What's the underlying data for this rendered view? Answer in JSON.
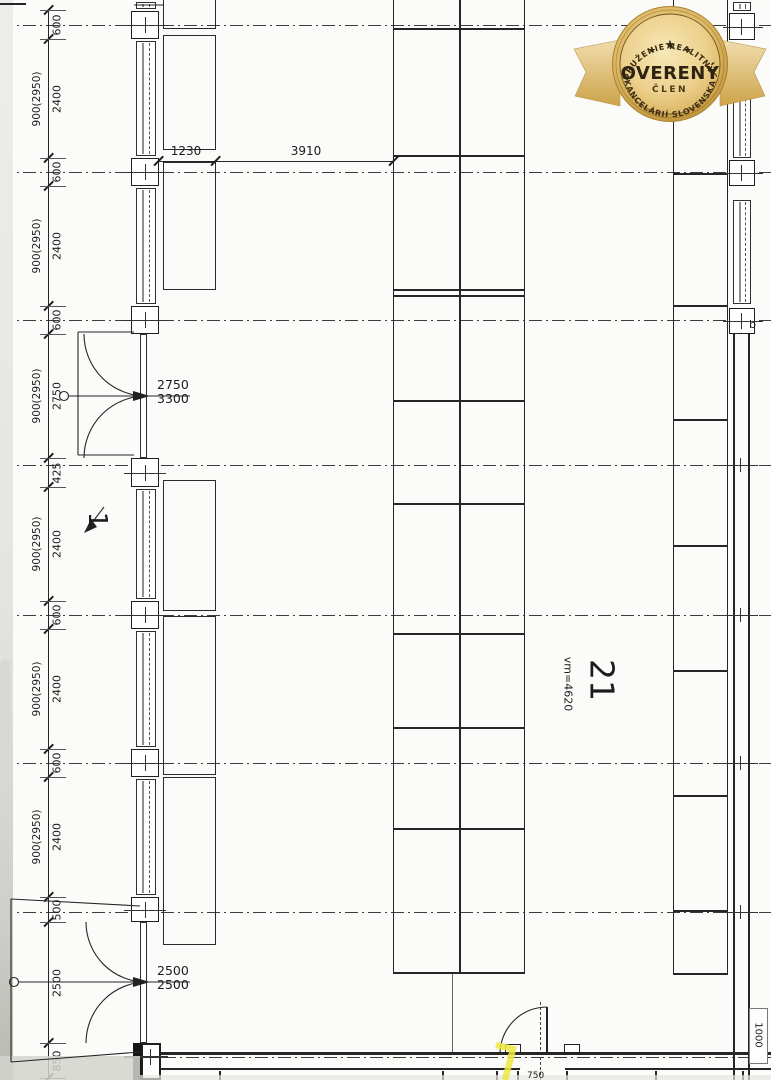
{
  "badge": {
    "arc_top": "ZDRUŽENIE REALITNÝCH",
    "title": "OVERENÝ",
    "subtitle": "ČLEN",
    "arc_bottom": "KANCELÁRIÍ SLOVENSKA",
    "star": "★",
    "colors": {
      "gold_dark": "#c4953a",
      "gold_light": "#f3e2ac",
      "text": "#342712"
    }
  },
  "room_labels": {
    "room1": "1",
    "room21": "21",
    "room21_area": "vm=4620"
  },
  "dim_labels": {
    "rack_depth": "1230",
    "aisle": "3910",
    "door_mid_top": "2750",
    "door_mid_bottom": "3300",
    "door_bottom_top": "2500",
    "door_bottom_bottom": "2500",
    "right_side": "1000",
    "bottom_partial": "750",
    "wall_mark": "b"
  },
  "left_chain": {
    "segments": [
      {
        "label": "600",
        "y0": 10,
        "y1": 39
      },
      {
        "label": "2400",
        "paren": "900(2950)",
        "y0": 39,
        "y1": 158
      },
      {
        "label": "600",
        "y0": 158,
        "y1": 186
      },
      {
        "label": "2400",
        "paren": "900(2950)",
        "y0": 186,
        "y1": 306
      },
      {
        "label": "600",
        "y0": 306,
        "y1": 334
      },
      {
        "label": "2750",
        "paren": "900(2950)",
        "y0": 334,
        "y1": 458
      },
      {
        "label": "425",
        "y0": 458,
        "y1": 487
      },
      {
        "label": "2400",
        "paren": "900(2950)",
        "y0": 487,
        "y1": 601
      },
      {
        "label": "600",
        "y0": 601,
        "y1": 629
      },
      {
        "label": "2400",
        "paren": "900(2950)",
        "y0": 629,
        "y1": 749
      },
      {
        "label": "600",
        "y0": 749,
        "y1": 777
      },
      {
        "label": "2400",
        "paren": "900(2950)",
        "y0": 777,
        "y1": 897
      },
      {
        "label": "500",
        "y0": 897,
        "y1": 922
      },
      {
        "label": "2500",
        "y0": 922,
        "y1": 1043
      },
      {
        "label": "850",
        "y0": 1043,
        "y1": 1078
      }
    ]
  },
  "plan": {
    "ink": "#262626",
    "chain_x": 48,
    "centerlines_y": [
      25,
      172,
      320,
      465,
      615,
      763,
      912
    ],
    "bottom_axis_y": 1057,
    "left_wall": {
      "windows": [
        [
          0,
          11
        ],
        [
          39,
          158
        ],
        [
          186,
          306
        ],
        [
          487,
          601
        ],
        [
          629,
          749
        ],
        [
          777,
          897
        ]
      ],
      "pillars": [
        [
          11,
          39
        ],
        [
          158,
          186
        ],
        [
          306,
          334
        ],
        [
          458,
          487
        ],
        [
          601,
          629
        ],
        [
          749,
          777
        ],
        [
          897,
          922
        ]
      ]
    },
    "right_wall": {
      "windows": [
        [
          0,
          13
        ],
        [
          45,
          160
        ],
        [
          198,
          306
        ]
      ],
      "pillars": [
        [
          13,
          40
        ],
        [
          160,
          186
        ],
        [
          308,
          334
        ]
      ],
      "plain": [
        334,
        1080
      ],
      "cross_y": [
        465,
        615,
        763,
        912
      ]
    },
    "left_racks": [
      [
        0,
        29
      ],
      [
        35,
        150
      ],
      [
        162,
        290
      ],
      [
        480,
        611
      ],
      [
        616,
        775
      ],
      [
        777,
        945
      ]
    ],
    "center_rack": {
      "x": 393,
      "w": 132,
      "split": 459,
      "y0": 0,
      "y1": 974,
      "rows": [
        28,
        155,
        289,
        295,
        400,
        503,
        633,
        727,
        828
      ]
    },
    "right_rack": {
      "x": 673,
      "w": 55,
      "y0": 0,
      "y1": 975,
      "rows": [
        45,
        173,
        305,
        419,
        545,
        670,
        795,
        910
      ]
    },
    "bottom_stubs": [
      219,
      442,
      496,
      517,
      566,
      655,
      742
    ],
    "top_dim_line": {
      "y": 161,
      "x0": 158,
      "x1": 393,
      "ticks": [
        158,
        215,
        393
      ]
    }
  }
}
